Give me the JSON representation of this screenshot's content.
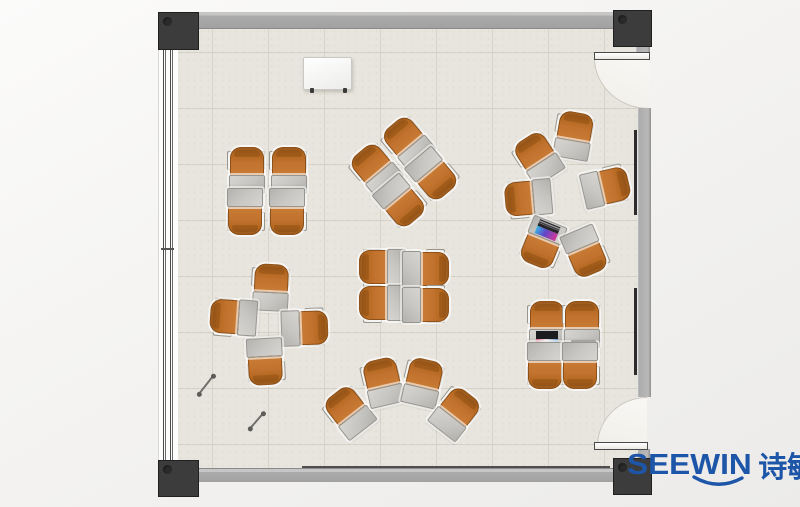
{
  "logo": {
    "brand": "SEEWIN",
    "cjk": "诗敏",
    "color": "#1d55a8"
  },
  "palette": {
    "background_outer": "#f4f3f1",
    "floor": "#e8e5de",
    "grid_line": "rgba(150,145,128,0.22)",
    "wall_gray": "#ababab",
    "post_dark": "#3c3c3c",
    "chair_orange": "#c1722e",
    "desk_gray": "#c6c5c1",
    "door_leaf_white": "#f6f5f2",
    "laptop_screen_color": "#d83898",
    "laptop_dark": "#24262b"
  },
  "floorplan": {
    "room": {
      "x": 158,
      "y": 12,
      "width": 492,
      "height": 483
    },
    "clusters": [
      {
        "name": "quad-top-left",
        "type": "quad-facing-pairs",
        "cx": 267,
        "cy": 191,
        "rot": 0,
        "units": [
          {
            "x": -21,
            "y": -21,
            "r": 0
          },
          {
            "x": 21,
            "y": -21,
            "r": 0
          },
          {
            "x": -21,
            "y": 21,
            "r": 180
          },
          {
            "x": 21,
            "y": 21,
            "r": 180
          }
        ]
      },
      {
        "name": "quad-top-middle-diamond",
        "type": "quad-facing-pairs",
        "cx": 404,
        "cy": 172,
        "rot": -40,
        "units": [
          {
            "x": -21,
            "y": -21,
            "r": 0
          },
          {
            "x": 21,
            "y": -21,
            "r": 0
          },
          {
            "x": -21,
            "y": 21,
            "r": 180
          },
          {
            "x": 21,
            "y": 21,
            "r": 180
          }
        ]
      },
      {
        "name": "circle-right",
        "type": "circle-of-six",
        "cx": 562,
        "cy": 196,
        "rot": 0,
        "units": [
          {
            "x": 11,
            "y": -61,
            "r": 10
          },
          {
            "x": -25,
            "y": -38,
            "r": -33
          },
          {
            "x": -34,
            "y": 3,
            "r": -95
          },
          {
            "x": -19,
            "y": 48,
            "r": -158,
            "laptop": "open-color"
          },
          {
            "x": 24,
            "y": 56,
            "r": 157
          },
          {
            "x": 44,
            "y": -10,
            "r": 77
          }
        ]
      },
      {
        "name": "pinwheel-left",
        "type": "cross-facing-center",
        "cx": 269,
        "cy": 325,
        "rot": 0,
        "units": [
          {
            "x": 1,
            "y": -38,
            "r": 3
          },
          {
            "x": -36,
            "y": -7,
            "r": -86
          },
          {
            "x": 36,
            "y": 2,
            "r": 88
          },
          {
            "x": -3,
            "y": 37,
            "r": 177
          }
        ]
      },
      {
        "name": "quad-center",
        "type": "quad-facing-pairs",
        "cx": 404,
        "cy": 286,
        "rot": 0,
        "units": [
          {
            "x": -22,
            "y": -18,
            "r": -90
          },
          {
            "x": -22,
            "y": 18,
            "r": -90
          },
          {
            "x": 22,
            "y": -18,
            "r": 90
          },
          {
            "x": 22,
            "y": 18,
            "r": 90
          }
        ]
      },
      {
        "name": "fan-bottom",
        "type": "arc-facing-wall",
        "cx": 401,
        "cy": 397,
        "rot": 0,
        "units": [
          {
            "x": -53,
            "y": 15,
            "r": -38
          },
          {
            "x": -19,
            "y": -15,
            "r": -13
          },
          {
            "x": 21,
            "y": -15,
            "r": 13
          },
          {
            "x": 54,
            "y": 15,
            "r": 38
          }
        ]
      },
      {
        "name": "quad-bottom-right",
        "type": "quad-facing-pairs",
        "cx": 563,
        "cy": 345,
        "rot": 0,
        "units": [
          {
            "x": -17,
            "y": -21,
            "r": 0,
            "laptop": "open-dark"
          },
          {
            "x": 18,
            "y": -21,
            "r": 0,
            "laptop": "closed"
          },
          {
            "x": -17,
            "y": 21,
            "r": 180
          },
          {
            "x": 18,
            "y": 21,
            "r": 180
          }
        ]
      }
    ],
    "objects": {
      "whiteboard": {
        "x": 303,
        "y": 57,
        "w": 47,
        "h": 31
      },
      "pens": [
        {
          "cx": 206,
          "cy": 384,
          "len": 24,
          "angle": -52
        },
        {
          "cx": 256,
          "cy": 420,
          "len": 21,
          "angle": -49
        }
      ],
      "wall_marks": {
        "top_line": {
          "x1": 283,
          "x2": 527,
          "y": 23,
          "h": 3
        },
        "top_ticks": [
          298,
          330,
          368
        ],
        "bottom_line": {
          "x1": 302,
          "x2": 610,
          "y": 466,
          "h": 3
        },
        "right_segments": [
          {
            "x": 634,
            "y1": 130,
            "y2": 215
          },
          {
            "x": 634,
            "y1": 288,
            "y2": 375
          }
        ]
      }
    }
  }
}
